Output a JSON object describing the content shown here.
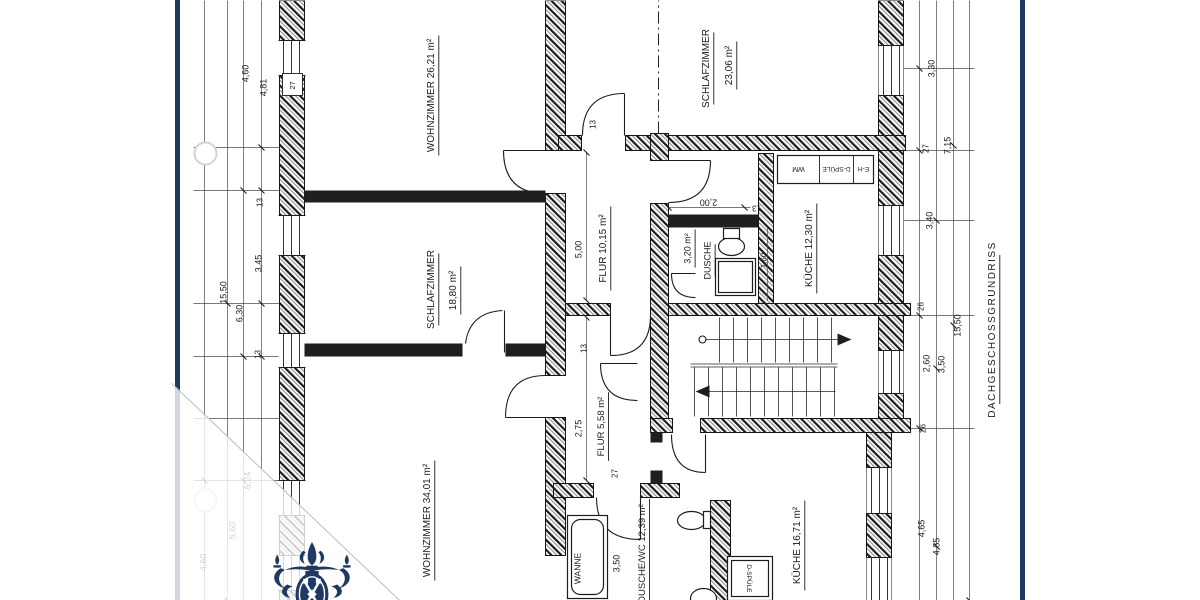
{
  "document": {
    "type": "scanned-floor-plan"
  },
  "page": {
    "background": "#ffffff",
    "edge_color": "#1f3b60",
    "line_color": "#1c1c1c",
    "fold_line_color": "#bcbcbc",
    "overlay_color": "rgba(255,255,255,0.8)"
  },
  "watermark": {
    "name": "crest-logo",
    "color": "#1e3a63"
  },
  "rooms": [
    {
      "name": "WOHNZIMMER",
      "area": "26,21 m²"
    },
    {
      "name": "SCHLAFZIMMER",
      "area": "23,06 m²"
    },
    {
      "name": "SCHLAFZIMMER",
      "area": "18,80 m²"
    },
    {
      "name": "WOHNZIMMER",
      "area": "34,01 m²"
    },
    {
      "name": "FLUR",
      "area": "10,15 m²"
    },
    {
      "name": "FLUR",
      "area": "5,58 m²"
    },
    {
      "name": "KÜCHE",
      "area": "12,30 m²"
    },
    {
      "name": "KÜCHE",
      "area": "16,71 m²"
    },
    {
      "name": "DUSCHE",
      "area": "3,20 m²"
    },
    {
      "name": "DUSCHE/WC",
      "area": "12,39 m²"
    }
  ],
  "fixtures": [
    "WANNE",
    "D-SPÜLE",
    "E-H",
    "WM"
  ],
  "plan": {
    "title": "DACHGESCHOSSGRUNDRISS",
    "texts": [
      {
        "t": "WOHNZIMMER  26,21 m²",
        "x": 505,
        "y": 251,
        "s": 10,
        "u": 1,
        "n": "room-label-wohnzimmer-1"
      },
      {
        "t": "SCHLAFZIMMER",
        "x": 311,
        "y": 251,
        "s": 10,
        "u": 1,
        "n": "room-label-schlafzimmer-1"
      },
      {
        "t": "18,80 m²",
        "x": 310,
        "y": 273,
        "s": 10,
        "u": 1,
        "n": "room-area-schlafzimmer-1"
      },
      {
        "t": "WOHNZIMMER  34,01 m²",
        "x": 80,
        "y": 247,
        "s": 10,
        "u": 1,
        "n": "room-label-wohnzimmer-2"
      },
      {
        "t": "SCHLAFZIMMER",
        "x": 532,
        "y": 526,
        "s": 10,
        "u": 1,
        "n": "room-label-schlafzimmer-2"
      },
      {
        "t": "23,06 m²",
        "x": 535,
        "y": 549,
        "s": 10,
        "u": 1,
        "n": "room-area-schlafzimmer-2"
      },
      {
        "t": "FLUR  10,15 m²",
        "x": 352,
        "y": 423,
        "s": 10,
        "u": 1,
        "n": "room-label-flur-1"
      },
      {
        "t": "FLUR 5,58 m²",
        "x": 174,
        "y": 421,
        "s": 9.5,
        "u": 1,
        "n": "room-label-flur-2"
      },
      {
        "t": "KÜCHE  12,30 m²",
        "x": 352,
        "y": 629,
        "s": 10,
        "u": 1,
        "n": "room-label-kueche-1"
      },
      {
        "t": "KÜCHE  16,71 m²",
        "x": 55,
        "y": 617,
        "s": 10,
        "u": 1,
        "n": "room-label-kueche-2"
      },
      {
        "t": "DUSCHE/WC  12,39 m²",
        "x": 47,
        "y": 462,
        "s": 9.5,
        "u": 1,
        "n": "room-label-dusche-wc"
      },
      {
        "t": "3,20 m²",
        "x": 352,
        "y": 508,
        "s": 9,
        "u": 1,
        "n": "room-area-dusche"
      },
      {
        "t": "DUSCHE",
        "x": 340,
        "y": 528,
        "s": 9,
        "u": 1,
        "n": "room-label-dusche"
      },
      {
        "t": "WANNE",
        "x": 32,
        "y": 398,
        "s": 8.5,
        "n": "fixture-label-wanne"
      },
      {
        "t": "WM",
        "x": 431,
        "y": 619,
        "s": 7,
        "r": -90,
        "n": "fixture-label-wm"
      },
      {
        "t": "D-SPÜLE",
        "x": 431,
        "y": 657,
        "s": 6.5,
        "r": -90,
        "n": "fixture-label-spuele-1"
      },
      {
        "t": "E-H",
        "x": 431,
        "y": 684,
        "s": 6.5,
        "r": -90,
        "n": "fixture-label-eh"
      },
      {
        "t": "D-SPÜLE",
        "x": 22,
        "y": 570,
        "s": 6.5,
        "r": 180,
        "n": "fixture-label-spuele-2"
      },
      {
        "t": "DACHGESCHOSSGRUNDRISS",
        "x": 271,
        "y": 812,
        "s": 10,
        "u": 1,
        "ls": 1.5,
        "n": "plan-title"
      },
      {
        "t": "5,00",
        "x": 351,
        "y": 399,
        "s": 9,
        "n": "dim-label"
      },
      {
        "t": "2,75",
        "x": 172,
        "y": 399,
        "s": 9,
        "n": "dim-label"
      },
      {
        "t": "13",
        "x": 476,
        "y": 413,
        "s": 8,
        "n": "dim-label"
      },
      {
        "t": "13",
        "x": 252,
        "y": 404,
        "s": 8,
        "n": "dim-label"
      },
      {
        "t": "2,00",
        "x": 398,
        "y": 529,
        "s": 9,
        "r": -90,
        "n": "dim-label"
      },
      {
        "t": "13",
        "x": 392,
        "y": 577,
        "s": 8,
        "r": -90,
        "n": "dim-label"
      },
      {
        "t": "1,60",
        "x": 340,
        "y": 584,
        "s": 8,
        "n": "dim-label"
      },
      {
        "t": "27",
        "x": 127,
        "y": 435,
        "s": 8,
        "n": "dim-label"
      },
      {
        "t": "3,50",
        "x": 37,
        "y": 437,
        "s": 9,
        "n": "dim-label"
      },
      {
        "t": "4,60",
        "x": 527,
        "y": 66,
        "s": 9,
        "n": "dim-label"
      },
      {
        "t": "4,81",
        "x": 513,
        "y": 84,
        "s": 9,
        "n": "dim-label"
      },
      {
        "t": "13",
        "x": 398,
        "y": 80,
        "s": 8,
        "n": "dim-label"
      },
      {
        "t": "3,45",
        "x": 337,
        "y": 79,
        "s": 9,
        "n": "dim-label"
      },
      {
        "t": "15,50",
        "x": 308,
        "y": 44,
        "s": 9,
        "n": "dim-label"
      },
      {
        "t": "6,30",
        "x": 287,
        "y": 60,
        "s": 9,
        "n": "dim-label"
      },
      {
        "t": "13",
        "x": 246,
        "y": 78,
        "s": 8,
        "n": "dim-label"
      },
      {
        "t": "6,24",
        "x": 120,
        "y": 68,
        "s": 9,
        "n": "dim-label"
      },
      {
        "t": "5,60",
        "x": 70,
        "y": 53,
        "s": 9,
        "n": "dim-label"
      },
      {
        "t": "4,60",
        "x": 38,
        "y": 24,
        "s": 9,
        "n": "dim-label"
      },
      {
        "t": "3,30",
        "x": 532,
        "y": 752,
        "s": 9,
        "n": "dim-label"
      },
      {
        "t": "27",
        "x": 452,
        "y": 746,
        "s": 8,
        "n": "dim-label"
      },
      {
        "t": "7,15",
        "x": 455,
        "y": 768,
        "s": 9,
        "n": "dim-label"
      },
      {
        "t": "3,40",
        "x": 380,
        "y": 750,
        "s": 9,
        "n": "dim-label"
      },
      {
        "t": "26",
        "x": 294,
        "y": 741,
        "s": 8,
        "n": "dim-label"
      },
      {
        "t": "15,50",
        "x": 275,
        "y": 778,
        "s": 9,
        "n": "dim-label"
      },
      {
        "t": "2,60",
        "x": 237,
        "y": 747,
        "s": 9,
        "n": "dim-label"
      },
      {
        "t": "3,50",
        "x": 236,
        "y": 762,
        "s": 9,
        "n": "dim-label"
      },
      {
        "t": "26",
        "x": 172,
        "y": 743,
        "s": 8,
        "n": "dim-label"
      },
      {
        "t": "4,65",
        "x": 72,
        "y": 742,
        "s": 9,
        "n": "dim-label"
      },
      {
        "t": "4,85",
        "x": 54,
        "y": 757,
        "s": 9,
        "n": "dim-label"
      },
      {
        "t": "27",
        "x": 515,
        "y": 113,
        "s": 7.5,
        "n": "dim-label"
      }
    ]
  }
}
